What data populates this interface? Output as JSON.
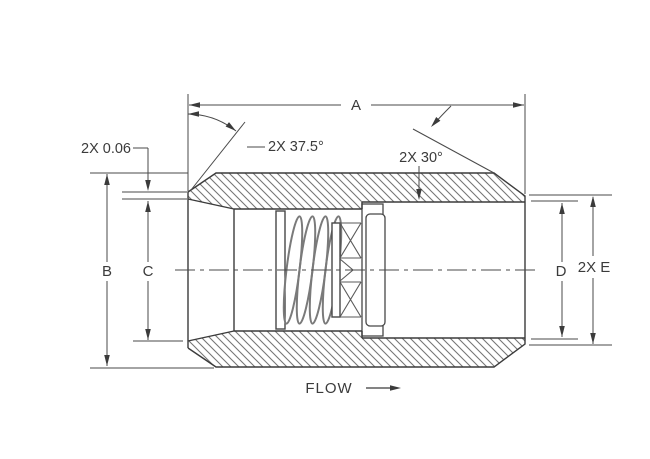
{
  "drawing": {
    "title": "check-valve-cross-section",
    "labels": {
      "dim_a": "A",
      "dim_b": "B",
      "dim_c": "C",
      "dim_d": "D",
      "dim_e": "2X E",
      "tip_flat": "2X 0.06",
      "nose_angle": "2X 37.5°",
      "chamfer_angle": "2X 30°",
      "flow": "FLOW"
    },
    "colors": {
      "line": "#3b3b3b",
      "thin_line": "#4a4a4a",
      "hatch": "#767676",
      "internal": "#777777",
      "background": "#ffffff"
    }
  }
}
